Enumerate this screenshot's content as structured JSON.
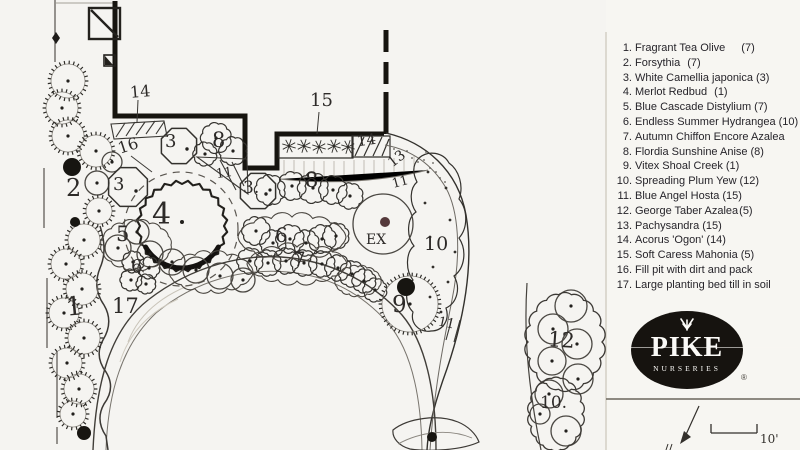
{
  "title": "Pike Nurseries landscape planting plan",
  "legend": {
    "items": [
      {
        "n": "1.",
        "name": "Fragrant Tea Olive",
        "qty": "(7)",
        "gap": "wide"
      },
      {
        "n": "2.",
        "name": "Forsythia",
        "qty": "(7)",
        "gap": "mid"
      },
      {
        "n": "3.",
        "name": "White Camellia japonica",
        "qty": "(3)",
        "gap": "none"
      },
      {
        "n": "4.",
        "name": "Merlot Redbud",
        "qty": "(1)",
        "gap": "mid"
      },
      {
        "n": "5.",
        "name": "Blue Cascade Distylium",
        "qty": "(7)",
        "gap": "none"
      },
      {
        "n": "6.",
        "name": "Endless Summer Hydrangea",
        "qty": "(10)",
        "gap": "none"
      },
      {
        "n": "7.",
        "name": "Autumn Chiffon Encore Azalea",
        "qty": "(13)",
        "gap": "wide"
      },
      {
        "n": "8.",
        "name": "Flordia Sunshine Anise",
        "qty": "(8)",
        "gap": "none"
      },
      {
        "n": "9.",
        "name": "Vitex Shoal Creek",
        "qty": "(1)",
        "gap": "none"
      },
      {
        "n": "10.",
        "name": "Spreading Plum Yew",
        "qty": "(12)",
        "gap": "none"
      },
      {
        "n": "11.",
        "name": "Blue Angel Hosta",
        "qty": "(15)",
        "gap": "none"
      },
      {
        "n": "12.",
        "name": "George Taber Azalea",
        "qty": "(5)",
        "gap": "tight"
      },
      {
        "n": "13.",
        "name": "Pachysandra",
        "qty": "(15)",
        "gap": "none"
      },
      {
        "n": "14.",
        "name": "Acorus 'Ogon'",
        "qty": "(14)",
        "gap": "none"
      },
      {
        "n": "15.",
        "name": "Soft Caress Mahonia",
        "qty": "(5)",
        "gap": "none"
      },
      {
        "n": "16.",
        "name": "Fill pit with dirt and pack",
        "qty": "",
        "gap": "none"
      },
      {
        "n": "17.",
        "name": "Large planting bed till in soil",
        "qty": "",
        "gap": "none"
      }
    ]
  },
  "logo": {
    "brand": "PIKE",
    "sub": "NURSERIES",
    "reg": "®"
  },
  "scale_label": "10'",
  "colors": {
    "ink": "#2b2a28",
    "paper": "#f5f4f1",
    "ex_dot": "#55393b"
  },
  "plan": {
    "labels": [
      {
        "t": "14",
        "x": 130,
        "y": 84,
        "s": 16,
        "r": -5
      },
      {
        "t": "16",
        "x": 118,
        "y": 138,
        "s": 16,
        "r": -18
      },
      {
        "t": "2",
        "x": 66,
        "y": 176,
        "s": 24,
        "r": 0
      },
      {
        "t": "3",
        "x": 165,
        "y": 133,
        "s": 18,
        "r": 0
      },
      {
        "t": "8",
        "x": 212,
        "y": 130,
        "s": 21,
        "r": 0
      },
      {
        "t": "3",
        "x": 113,
        "y": 176,
        "s": 18,
        "r": 0
      },
      {
        "t": "11",
        "x": 216,
        "y": 167,
        "s": 13,
        "r": -8
      },
      {
        "t": "15",
        "x": 310,
        "y": 92,
        "s": 18,
        "r": 0
      },
      {
        "t": "14",
        "x": 357,
        "y": 133,
        "s": 15,
        "r": -8
      },
      {
        "t": "13",
        "x": 388,
        "y": 152,
        "s": 14,
        "r": -38
      },
      {
        "t": "11",
        "x": 392,
        "y": 176,
        "s": 13,
        "r": -15
      },
      {
        "t": "3.",
        "x": 243,
        "y": 180,
        "s": 17,
        "r": 0
      },
      {
        "t": "8",
        "x": 305,
        "y": 170,
        "s": 21,
        "r": 0
      },
      {
        "t": "4",
        "x": 152,
        "y": 200,
        "s": 30,
        "r": 0
      },
      {
        "t": "5",
        "x": 116,
        "y": 224,
        "s": 21,
        "r": 0
      },
      {
        "t": "6",
        "x": 131,
        "y": 258,
        "s": 18,
        "r": 0
      },
      {
        "t": "6",
        "x": 275,
        "y": 225,
        "s": 20,
        "r": 0
      },
      {
        "t": "7",
        "x": 293,
        "y": 249,
        "s": 20,
        "r": 0
      },
      {
        "t": "1",
        "x": 66,
        "y": 294,
        "s": 26,
        "r": -5
      },
      {
        "t": "17",
        "x": 112,
        "y": 296,
        "s": 21,
        "r": 0
      },
      {
        "t": "EX",
        "x": 366,
        "y": 233,
        "s": 14,
        "r": 0
      },
      {
        "t": "10",
        "x": 424,
        "y": 235,
        "s": 19,
        "r": 0
      },
      {
        "t": "9",
        "x": 392,
        "y": 294,
        "s": 23,
        "r": 0
      },
      {
        "t": "11",
        "x": 438,
        "y": 317,
        "s": 13,
        "r": 12
      },
      {
        "t": "12",
        "x": 548,
        "y": 330,
        "s": 21,
        "r": 4
      },
      {
        "t": "10.",
        "x": 540,
        "y": 395,
        "s": 17,
        "r": 0
      }
    ],
    "plants": {
      "spiky": [
        [
          68,
          81,
          17
        ],
        [
          62,
          108,
          16
        ],
        [
          68,
          136,
          16
        ],
        [
          96,
          151,
          16
        ],
        [
          99,
          211,
          13
        ],
        [
          84,
          240,
          16
        ],
        [
          66,
          264,
          15
        ],
        [
          82,
          289,
          16
        ],
        [
          64,
          313,
          15
        ],
        [
          84,
          338,
          16
        ],
        [
          67,
          363,
          15
        ],
        [
          79,
          389,
          15
        ],
        [
          73,
          414,
          13
        ],
        [
          410,
          304,
          28
        ]
      ],
      "plain": [
        [
          97,
          183,
          12
        ],
        [
          112,
          162,
          10
        ],
        [
          118,
          248,
          13
        ],
        [
          137,
          232,
          12
        ],
        [
          150,
          254,
          13
        ],
        [
          172,
          262,
          13
        ],
        [
          196,
          270,
          13
        ],
        [
          220,
          276,
          13
        ],
        [
          243,
          280,
          12
        ],
        [
          571,
          306,
          16
        ],
        [
          553,
          329,
          15
        ],
        [
          577,
          344,
          15
        ],
        [
          552,
          361,
          14
        ],
        [
          578,
          379,
          15
        ],
        [
          549,
          394,
          14
        ],
        [
          566,
          431,
          15
        ],
        [
          540,
          414,
          10
        ],
        [
          383,
          224,
          30,
          0
        ]
      ],
      "cloud": [
        [
          216,
          138,
          14
        ],
        [
          233,
          151,
          13
        ],
        [
          205,
          154,
          11
        ],
        [
          270,
          190,
          14
        ],
        [
          292,
          186,
          13
        ],
        [
          313,
          188,
          14
        ],
        [
          333,
          190,
          13
        ],
        [
          350,
          196,
          12
        ],
        [
          256,
          231,
          13
        ],
        [
          273,
          243,
          12
        ],
        [
          290,
          239,
          13
        ],
        [
          306,
          243,
          12
        ],
        [
          322,
          239,
          13
        ],
        [
          336,
          236,
          12
        ],
        [
          133,
          262,
          10
        ],
        [
          149,
          268,
          10
        ],
        [
          131,
          280,
          10
        ],
        [
          146,
          284,
          9
        ],
        [
          250,
          261,
          12
        ],
        [
          268,
          263,
          12
        ],
        [
          286,
          261,
          12
        ],
        [
          304,
          263,
          12
        ],
        [
          322,
          264,
          12
        ],
        [
          338,
          268,
          12
        ],
        [
          352,
          274,
          12
        ],
        [
          364,
          281,
          11
        ],
        [
          375,
          290,
          11
        ]
      ],
      "filled": [
        [
          72,
          167,
          9
        ],
        [
          75,
          222,
          5
        ],
        [
          84,
          433,
          7
        ],
        [
          406,
          287,
          9
        ],
        [
          432,
          437,
          5
        ]
      ],
      "ex_dot": [
        385,
        222,
        5
      ],
      "octagons": [
        [
          179,
          146,
          19
        ],
        [
          128,
          187,
          21
        ],
        [
          258,
          191,
          19
        ]
      ],
      "oct_dots": [
        [
          187,
          149
        ],
        [
          136,
          191
        ],
        [
          266,
          194
        ]
      ],
      "starbursts": [
        [
          289,
          146
        ],
        [
          304,
          146
        ],
        [
          319,
          147
        ],
        [
          334,
          146
        ],
        [
          348,
          147
        ]
      ],
      "yew_dots": [
        [
          428,
          172
        ],
        [
          446,
          188
        ],
        [
          425,
          203
        ],
        [
          450,
          220
        ],
        [
          430,
          237
        ],
        [
          455,
          252
        ],
        [
          433,
          267
        ],
        [
          448,
          282
        ],
        [
          430,
          297
        ],
        [
          441,
          312
        ]
      ],
      "stipple": [
        [
          394,
          149
        ],
        [
          400,
          154
        ],
        [
          407,
          151
        ],
        [
          412,
          158
        ],
        [
          418,
          162
        ],
        [
          424,
          160
        ],
        [
          430,
          168
        ],
        [
          436,
          172
        ],
        [
          426,
          152
        ],
        [
          433,
          163
        ],
        [
          440,
          178
        ],
        [
          445,
          182
        ]
      ],
      "group_outlines": [
        [
          565,
          342,
          37,
          48
        ],
        [
          556,
          414,
          26,
          36
        ]
      ],
      "band_outlines": [
        [
          292,
          237,
          54,
          20
        ],
        [
          297,
          264,
          50,
          17
        ],
        [
          358,
          281,
          23,
          14
        ],
        [
          136,
          245,
          35,
          23
        ],
        [
          211,
          272,
          42,
          18
        ]
      ]
    }
  }
}
